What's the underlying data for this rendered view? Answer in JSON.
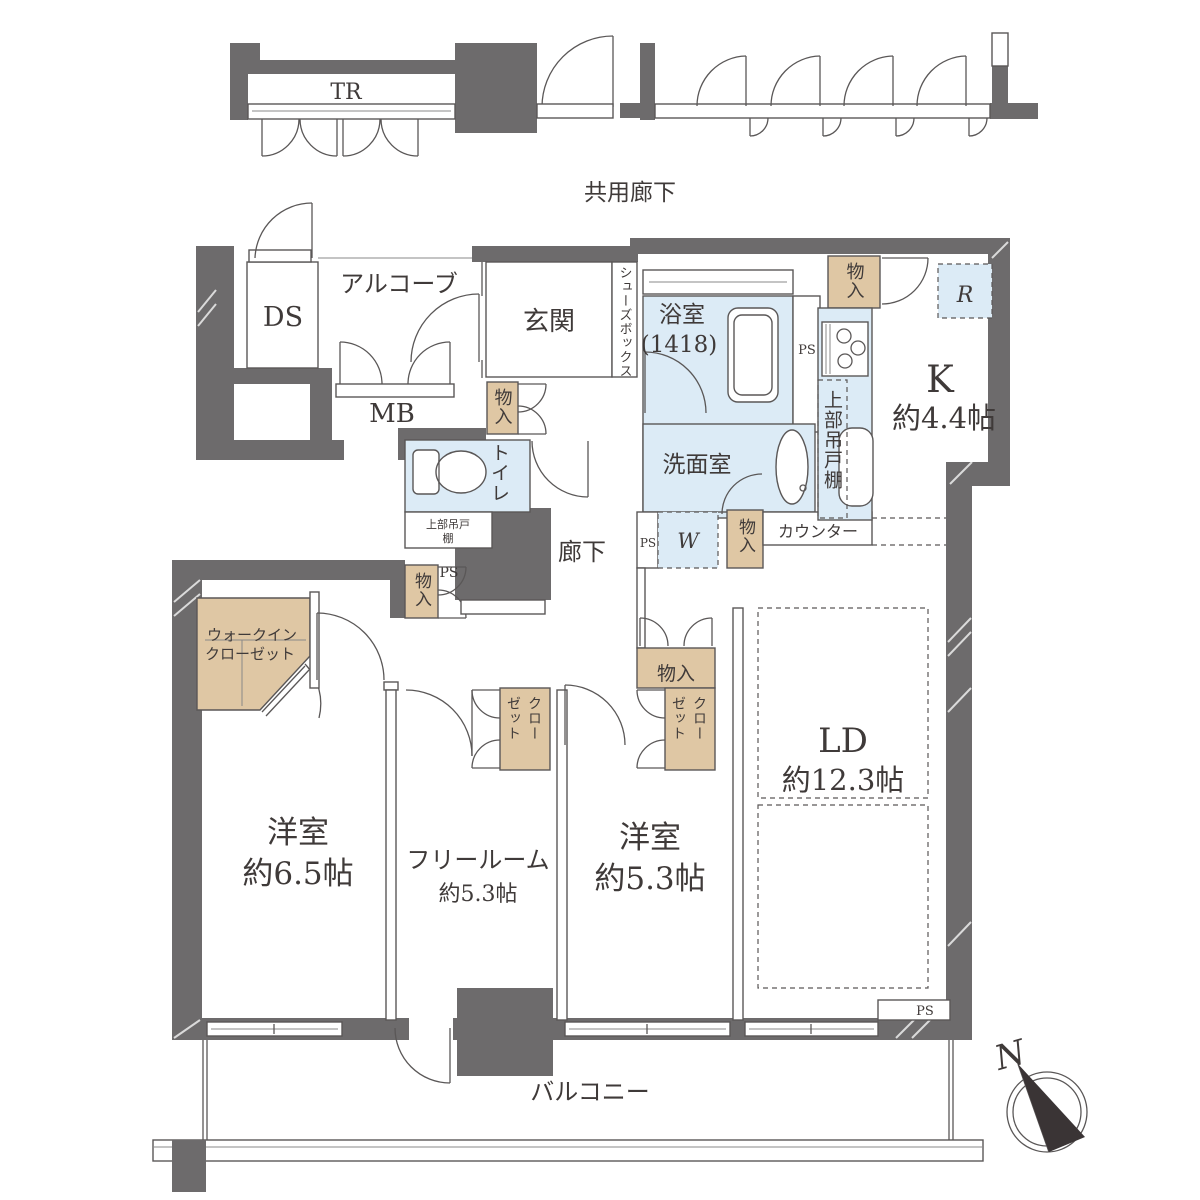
{
  "colors": {
    "wall": "#6d6b6c",
    "wet_area": "#dcebf6",
    "storage": "#dfc7a4",
    "line": "#5a5757",
    "text": "#3f3a39"
  },
  "labels": {
    "trunk_room": "TR",
    "common_corridor": "共用廊下",
    "duct_space": "DS",
    "alcove": "アルコーブ",
    "meter_box": "MB",
    "entrance": "玄関",
    "shoes_box": "シューズボックス",
    "bathroom": "浴室",
    "bathroom_size": "(1418)",
    "pipe_space": "PS",
    "storage": "物入",
    "toilet": "トイレ",
    "upper_cabinet": "上部吊戸棚",
    "upper_cabinet_line1": "上部吊戸",
    "upper_cabinet_line2": "棚",
    "washroom": "洗面室",
    "washer": "W",
    "counter": "カウンター",
    "refrigerator": "R",
    "kitchen": "K",
    "kitchen_size": "約4.4帖",
    "hallway": "廊下",
    "walkin_closet_line1": "ウォークイン",
    "walkin_closet_line2": "クローゼット",
    "closet_col1": "クロー",
    "closet_col2": "ゼット",
    "bedroom": "洋室",
    "bedroom1_size": "約6.5帖",
    "free_room": "フリールーム",
    "free_room_size": "約5.3帖",
    "bedroom2_size": "約5.3帖",
    "living_dining": "LD",
    "living_dining_size": "約12.3帖",
    "balcony": "バルコニー",
    "north": "N"
  }
}
